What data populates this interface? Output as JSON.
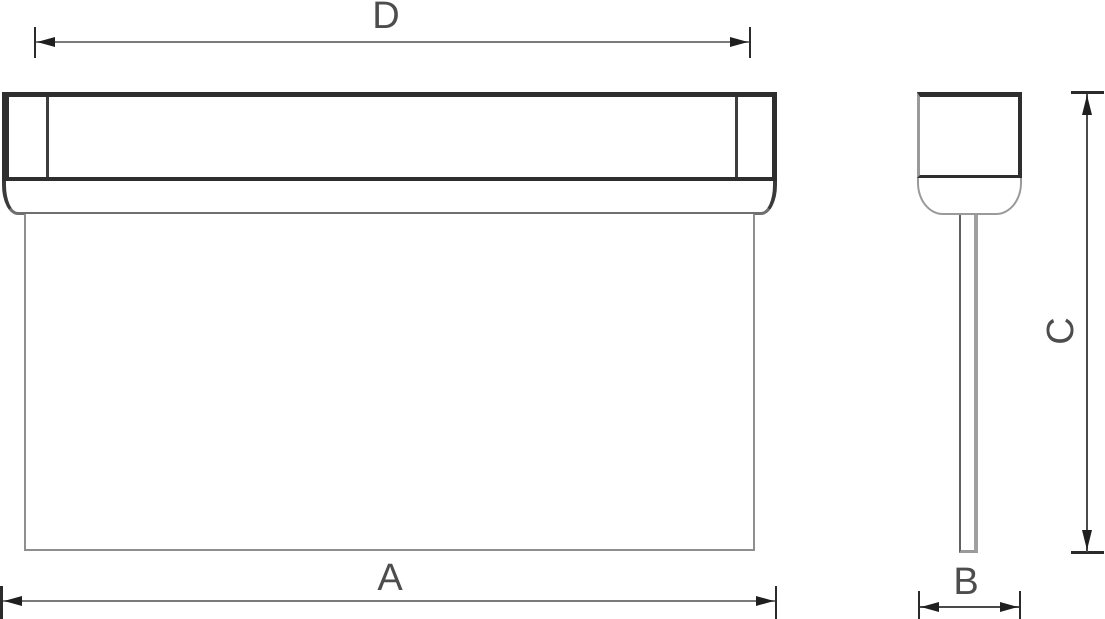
{
  "drawing": {
    "dimension_labels": {
      "a": "A",
      "b": "B",
      "c": "C",
      "d": "D"
    },
    "colors": {
      "background": "#ffffff",
      "outline_dark": "#2e2e2e",
      "thin_line_gray": "#8f8f8f",
      "dimension_line": "#7a7a7a",
      "arrow_and_tick": "#1f1f1f",
      "label_text": "#4d4d4d"
    }
  }
}
